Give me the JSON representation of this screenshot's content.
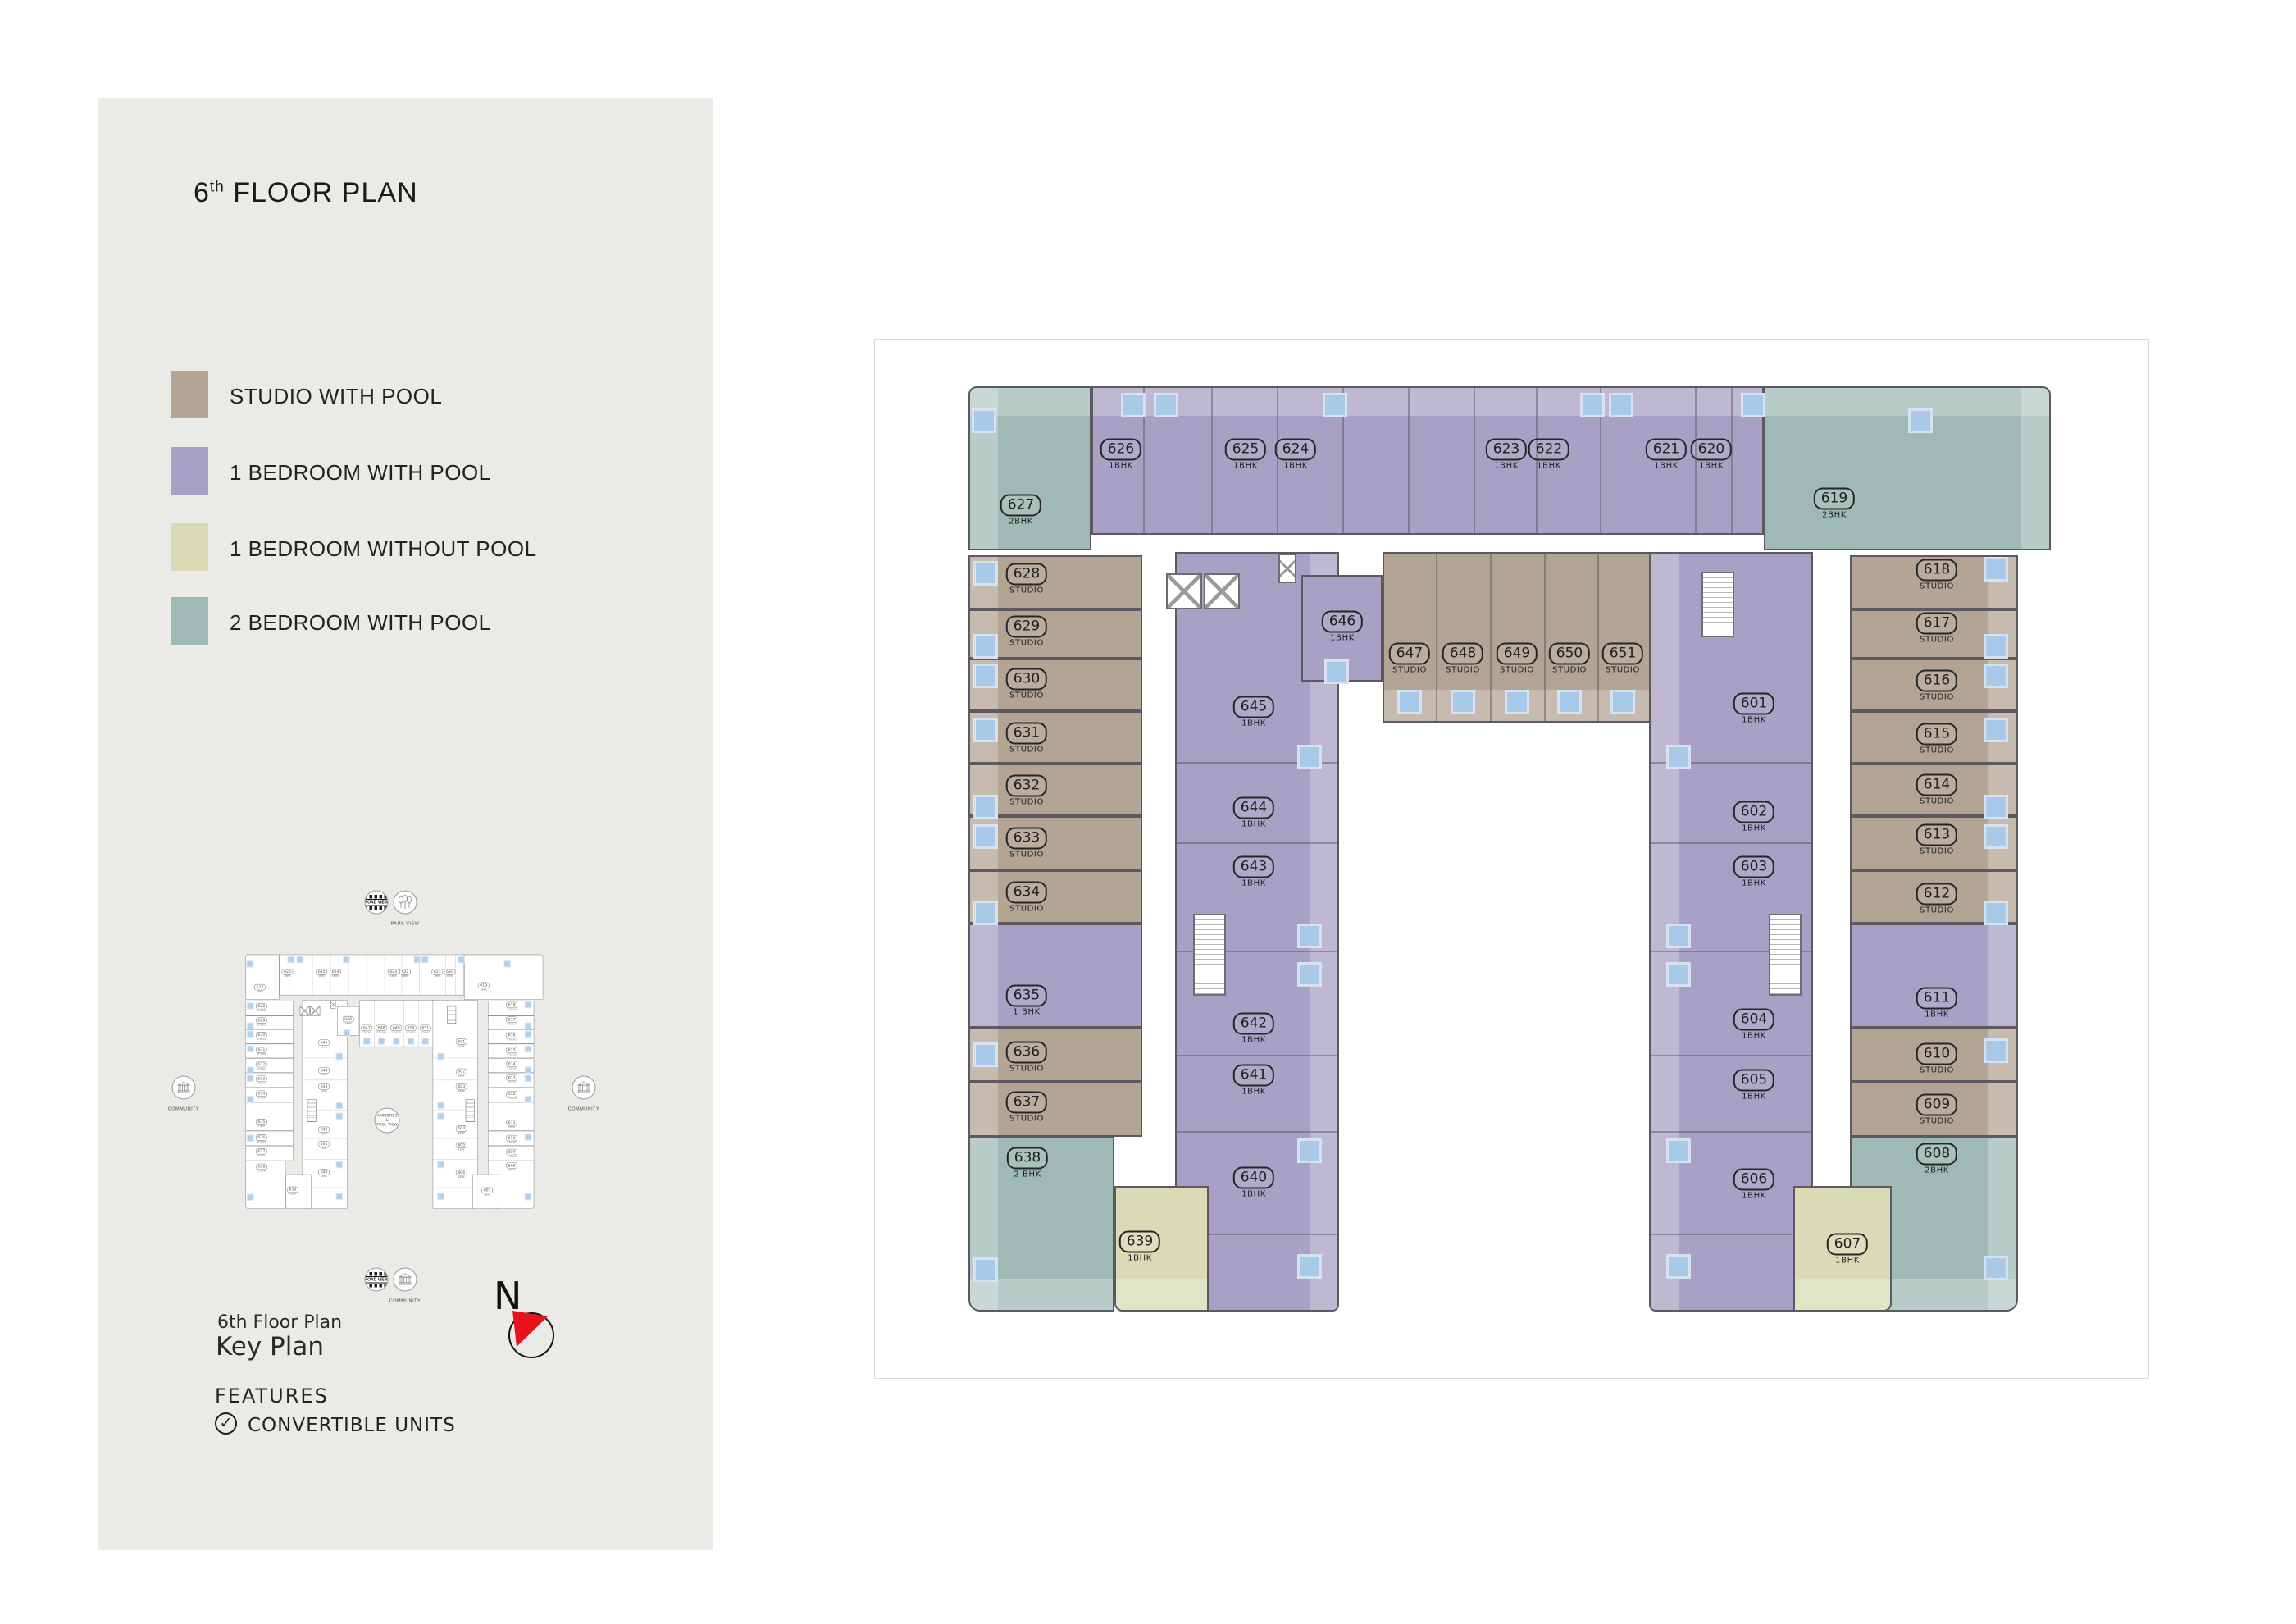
{
  "header": {
    "floor_number": "6",
    "floor_suffix": "th",
    "title_rest": "FLOOR PLAN"
  },
  "legend": {
    "items": [
      {
        "label": "STUDIO WITH POOL",
        "key": "sp",
        "color": "#b3a493"
      },
      {
        "label": "1 BEDROOM WITH POOL",
        "key": "bp",
        "color": "#a8a1c5"
      },
      {
        "label": "1 BEDROOM WITHOUT POOL",
        "key": "bn",
        "color": "#d8dbb6"
      },
      {
        "label": "2 BEDROOM WITH POOL",
        "key": "tp",
        "color": "#9fbab4"
      }
    ]
  },
  "key_plan": {
    "caption_line1": "6th Floor Plan",
    "caption_line2": "Key Plan",
    "north_label": "N",
    "center_label": "AMENITIES\n&\nPOOL VIEW",
    "icons": {
      "road_view": "ROAD VIEW",
      "park_view": "PARK VIEW",
      "community": "COMMUNITY"
    }
  },
  "features": {
    "heading": "FEATURES",
    "items": [
      "CONVERTIBLE UNITS"
    ]
  },
  "floor_plan": {
    "units": [
      {
        "id": "601",
        "type": "1BHK",
        "category": "bp"
      },
      {
        "id": "602",
        "type": "1BHK",
        "category": "bp"
      },
      {
        "id": "603",
        "type": "1BHK",
        "category": "bp"
      },
      {
        "id": "604",
        "type": "1BHK",
        "category": "bp"
      },
      {
        "id": "605",
        "type": "1BHK",
        "category": "bp"
      },
      {
        "id": "606",
        "type": "1BHK",
        "category": "bp"
      },
      {
        "id": "607",
        "type": "1BHK",
        "category": "bn"
      },
      {
        "id": "608",
        "type": "2BHK",
        "category": "tp"
      },
      {
        "id": "609",
        "type": "STUDIO",
        "category": "sp"
      },
      {
        "id": "610",
        "type": "STUDIO",
        "category": "sp"
      },
      {
        "id": "611",
        "type": "1BHK",
        "category": "bp"
      },
      {
        "id": "612",
        "type": "STUDIO",
        "category": "sp"
      },
      {
        "id": "613",
        "type": "STUDIO",
        "category": "sp"
      },
      {
        "id": "614",
        "type": "STUDIO",
        "category": "sp"
      },
      {
        "id": "615",
        "type": "STUDIO",
        "category": "sp"
      },
      {
        "id": "616",
        "type": "STUDIO",
        "category": "sp"
      },
      {
        "id": "617",
        "type": "STUDIO",
        "category": "sp"
      },
      {
        "id": "618",
        "type": "STUDIO",
        "category": "sp"
      },
      {
        "id": "619",
        "type": "2BHK",
        "category": "tp"
      },
      {
        "id": "620",
        "type": "1BHK",
        "category": "bp"
      },
      {
        "id": "621",
        "type": "1BHK",
        "category": "bp"
      },
      {
        "id": "622",
        "type": "1BHK",
        "category": "bp"
      },
      {
        "id": "623",
        "type": "1BHK",
        "category": "bp"
      },
      {
        "id": "624",
        "type": "1BHK",
        "category": "bp"
      },
      {
        "id": "625",
        "type": "1BHK",
        "category": "bp"
      },
      {
        "id": "626",
        "type": "1BHK",
        "category": "bp"
      },
      {
        "id": "627",
        "type": "2BHK",
        "category": "tp"
      },
      {
        "id": "628",
        "type": "STUDIO",
        "category": "sp"
      },
      {
        "id": "629",
        "type": "STUDIO",
        "category": "sp"
      },
      {
        "id": "630",
        "type": "STUDIO",
        "category": "sp"
      },
      {
        "id": "631",
        "type": "STUDIO",
        "category": "sp"
      },
      {
        "id": "632",
        "type": "STUDIO",
        "category": "sp"
      },
      {
        "id": "633",
        "type": "STUDIO",
        "category": "sp"
      },
      {
        "id": "634",
        "type": "STUDIO",
        "category": "sp"
      },
      {
        "id": "635",
        "type": "1 BHK",
        "category": "bp"
      },
      {
        "id": "636",
        "type": "STUDIO",
        "category": "sp"
      },
      {
        "id": "637",
        "type": "STUDIO",
        "category": "sp"
      },
      {
        "id": "638",
        "type": "2 BHK",
        "category": "tp"
      },
      {
        "id": "639",
        "type": "1BHK",
        "category": "bn"
      },
      {
        "id": "640",
        "type": "1BHK",
        "category": "bp"
      },
      {
        "id": "641",
        "type": "1BHK",
        "category": "bp"
      },
      {
        "id": "642",
        "type": "1BHK",
        "category": "bp"
      },
      {
        "id": "643",
        "type": "1BHK",
        "category": "bp"
      },
      {
        "id": "644",
        "type": "1BHK",
        "category": "bp"
      },
      {
        "id": "645",
        "type": "1BHK",
        "category": "bp"
      },
      {
        "id": "646",
        "type": "1BHK",
        "category": "bp"
      },
      {
        "id": "647",
        "type": "STUDIO",
        "category": "sp"
      },
      {
        "id": "648",
        "type": "STUDIO",
        "category": "sp"
      },
      {
        "id": "649",
        "type": "STUDIO",
        "category": "sp"
      },
      {
        "id": "650",
        "type": "STUDIO",
        "category": "sp"
      },
      {
        "id": "651",
        "type": "STUDIO",
        "category": "sp"
      }
    ]
  },
  "colors": {
    "panel_bg": "#eaebe6",
    "wall": "#5c5962",
    "pool_square": "#a9c9e9",
    "pool_square_border": "#d6e2ef",
    "north_red": "#e8121c",
    "categories": {
      "sp": "#b3a493",
      "bp": "#a8a1c5",
      "bn": "#d8dbb6",
      "tp": "#9fbab4"
    }
  }
}
